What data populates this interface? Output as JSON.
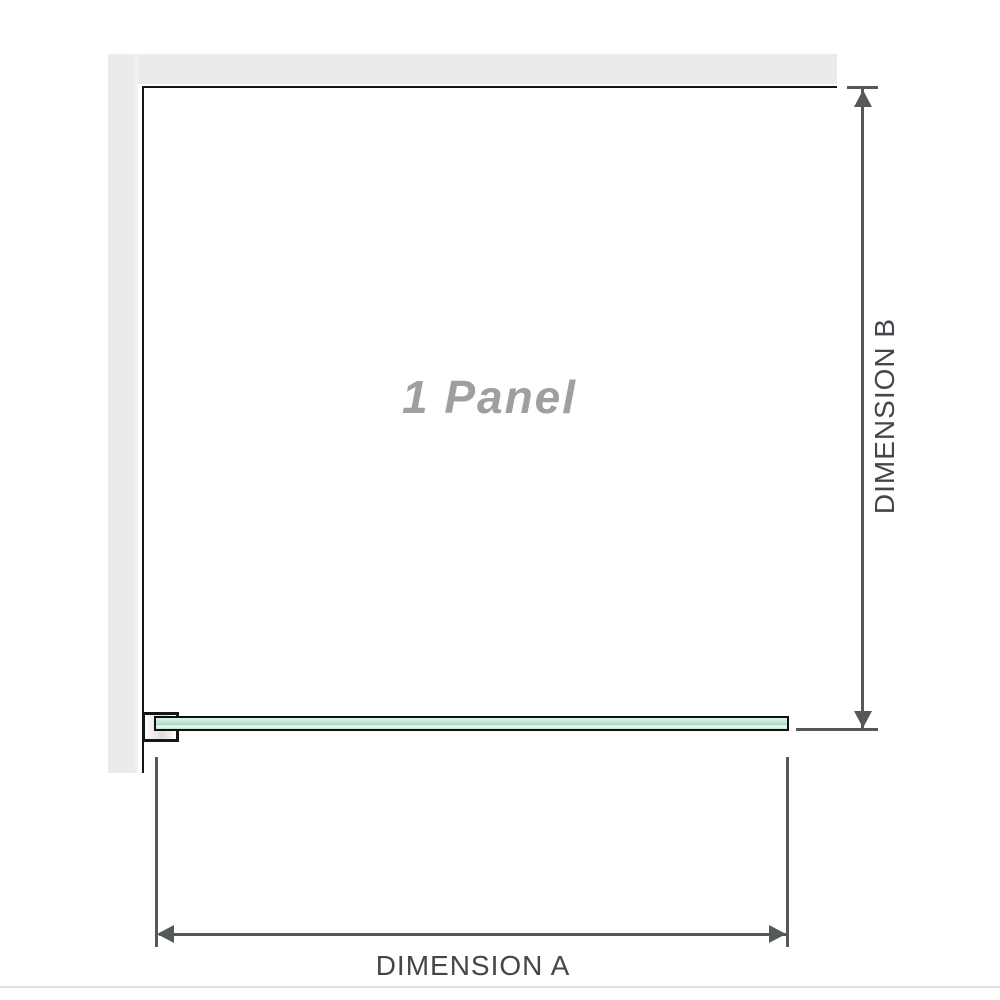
{
  "diagram": {
    "panel_label": "1 Panel",
    "dimension_a_label": "DIMENSION A",
    "dimension_b_label": "DIMENSION B"
  },
  "colors": {
    "wall": "#ebebeb",
    "outline": "#161616",
    "dimension_line": "#55595c",
    "label_text": "#43474b",
    "panel_label": "#9f9f9f",
    "glass_border": "#101010",
    "glass_light": "#e0f3e9",
    "glass_mid": "#a8dcc6",
    "glass_highlight": "#f2fbf7",
    "divider": "#e2e2de"
  }
}
